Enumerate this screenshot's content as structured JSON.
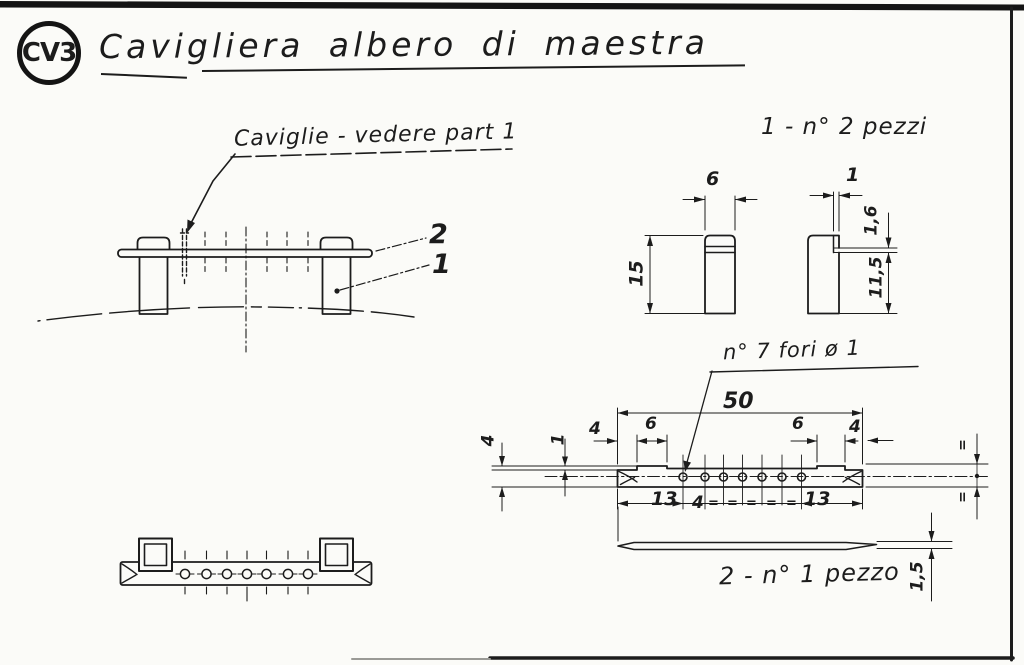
{
  "colors": {
    "ink": "#1c1c1c",
    "paper": "#fbfbf8"
  },
  "badge": {
    "code": "CV3"
  },
  "title": "Cavigliera albero di maestra",
  "notes": {
    "caviglie": "Caviglie - vedere part 1",
    "fori": "n° 7 fori ø 1",
    "piece1": "1 - n° 2 pezzi",
    "piece2": "2 - n° 1 pezzo"
  },
  "part_labels": {
    "rail": "2",
    "post": "1"
  },
  "dimensions": {
    "post_front": {
      "width": "6",
      "height": "15"
    },
    "post_side": {
      "notch_depth": "1",
      "cap_height": "1,6",
      "below_notch": "11,5"
    },
    "rail_plan": {
      "length": "50",
      "end_left": "4",
      "seat_left": "6",
      "seat_right": "6",
      "end_right": "4",
      "width": "4",
      "step": "1",
      "margin_left": "13",
      "pitch": "4",
      "equal_marks": [
        "=",
        "=",
        "=",
        "=",
        "="
      ],
      "margin_right": "13",
      "half_top": "=",
      "half_bottom": "="
    },
    "rail_side": {
      "thickness": "1,5"
    }
  }
}
